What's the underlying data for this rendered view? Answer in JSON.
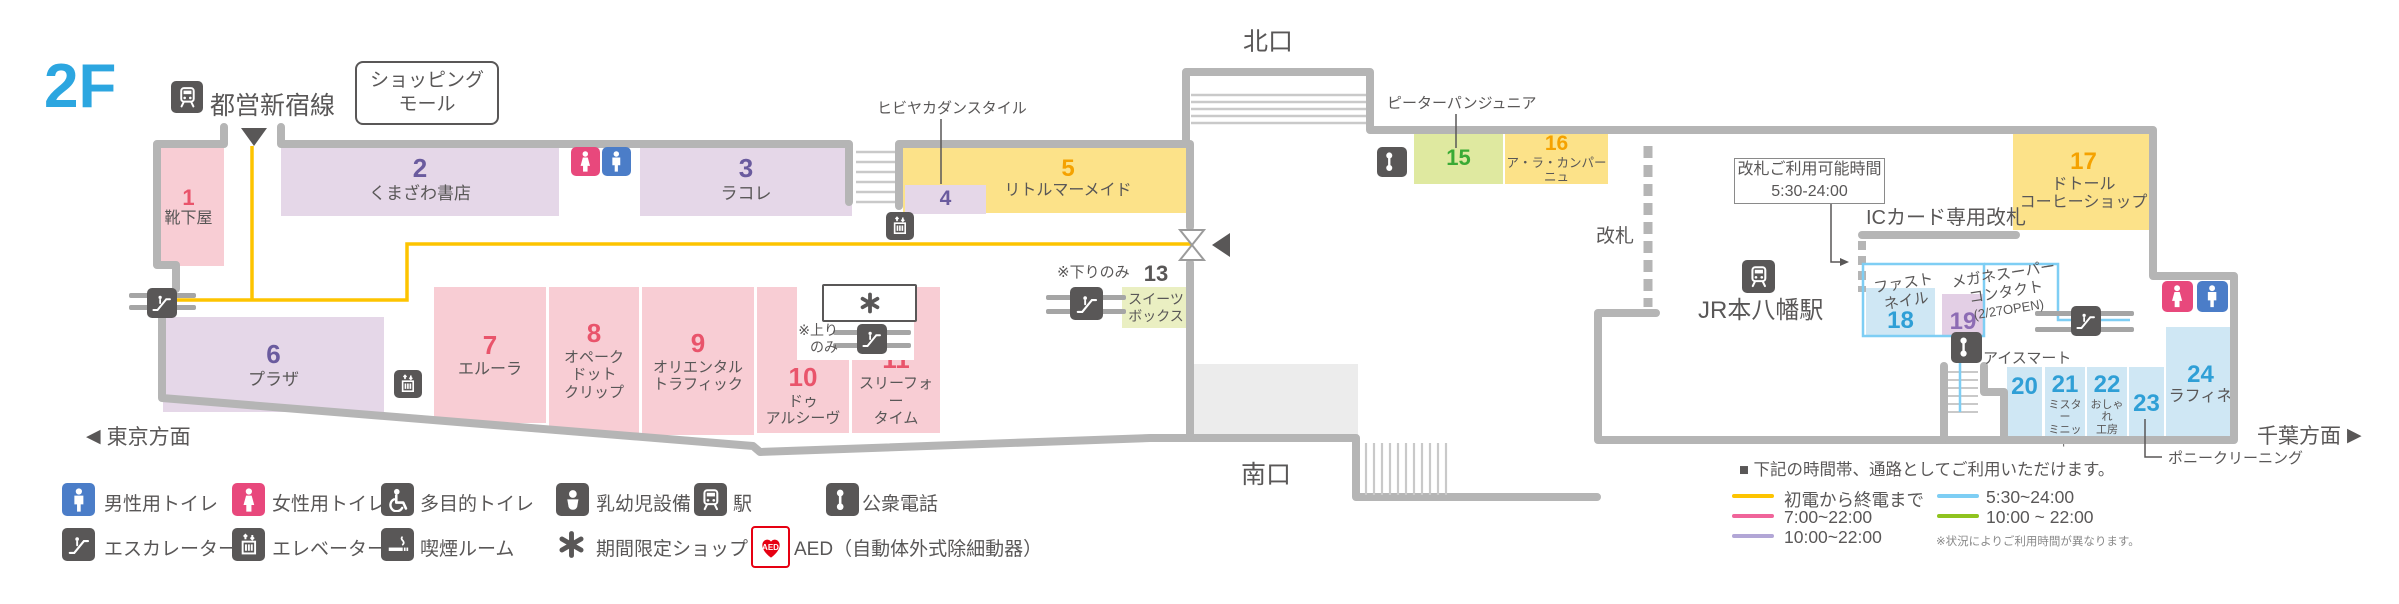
{
  "floor": "2F",
  "toei": {
    "label": "都営新宿線"
  },
  "mall": {
    "line1": "ショッピング",
    "line2": "モール"
  },
  "exits": {
    "north": "北口",
    "south": "南口"
  },
  "directions": {
    "west": "東京方面",
    "east": "千葉方面"
  },
  "station": {
    "jr": "JR本八幡駅",
    "kaisatsu": "改札",
    "ic_gate": "ICカード専用改札",
    "gate_hours_line1": "改札ご利用可能時間",
    "gate_hours_line2": "5:30-24:00"
  },
  "callouts": {
    "hibiya": "ヒビヤカダンスタイル",
    "peter": "ピーターパンジュニア",
    "pony": "ポニークリーニング",
    "ice": "アイスマート",
    "fastnail1": "ファスト",
    "fastnail2": "ネイル",
    "megane1": "メガネスーパー",
    "megane2": "コンタクト",
    "megane3": "(2/27OPEN)",
    "down_only": "※下りのみ",
    "up_only1": "※上り",
    "up_only2": "のみ"
  },
  "shops": {
    "s1": {
      "no": "1",
      "name": "靴下屋"
    },
    "s2": {
      "no": "2",
      "name": "くまざわ書店"
    },
    "s3": {
      "no": "3",
      "name": "ラコレ"
    },
    "s4": {
      "no": "4"
    },
    "s5": {
      "no": "5",
      "name": "リトルマーメイド"
    },
    "s6": {
      "no": "6",
      "name": "プラザ"
    },
    "s7": {
      "no": "7",
      "name": "エルーラ"
    },
    "s8": {
      "no": "8",
      "name1": "オペーク",
      "name2": "ドット",
      "name3": "クリップ"
    },
    "s9": {
      "no": "9",
      "name1": "オリエンタル",
      "name2": "トラフィック"
    },
    "s10": {
      "no": "10",
      "name1": "ドゥ",
      "name2": "アルシーヴ"
    },
    "s11": {
      "no": "11",
      "name1": "スリーフォー",
      "name2": "タイム"
    },
    "s13": {
      "no": "13",
      "name1": "スイーツ",
      "name2": "ボックス"
    },
    "s15": {
      "no": "15"
    },
    "s16": {
      "no": "16",
      "name": "ア・ラ・カンパーニュ"
    },
    "s17": {
      "no": "17",
      "name1": "ドトール",
      "name2": "コーヒーショップ"
    },
    "s18": {
      "no": "18"
    },
    "s19": {
      "no": "19"
    },
    "s20": {
      "no": "20"
    },
    "s21": {
      "no": "21",
      "name1": "ミスター",
      "name2": "ミニット"
    },
    "s22": {
      "no": "22",
      "name1": "おしゃれ",
      "name2": "工房"
    },
    "s23": {
      "no": "23"
    },
    "s24": {
      "no": "24",
      "name": "ラフィネ"
    }
  },
  "legend": {
    "row1": [
      {
        "label": "男性用トイレ"
      },
      {
        "label": "女性用トイレ"
      },
      {
        "label": "多目的トイレ"
      },
      {
        "label": "乳幼児設備"
      },
      {
        "label": "駅"
      },
      {
        "label": "公衆電話"
      }
    ],
    "row2": [
      {
        "label": "エスカレーター"
      },
      {
        "label": "エレベーター"
      },
      {
        "label": "喫煙ルーム"
      },
      {
        "label": "期間限定ショップ"
      },
      {
        "label": "AED（自動体外式除細動器）"
      }
    ],
    "aed_icon_text": "AED"
  },
  "hours": {
    "title": "■ 下記の時間帯、通路としてご利用いただけます。",
    "items": [
      {
        "color": "#fdc400",
        "label": "初電から終電まで"
      },
      {
        "color": "#f0649a",
        "label": "7:00~22:00"
      },
      {
        "color": "#b2a6d6",
        "label": "10:00~22:00"
      },
      {
        "color": "#7ecef4",
        "label": "5:30~24:00"
      },
      {
        "color": "#8fc31f",
        "label": "10:00 ~ 22:00"
      }
    ],
    "note": "※状況によりご利用時間が異なります。"
  },
  "colors": {
    "accent_blue": "#2ca6e0",
    "wall": "#b5b5b5",
    "route_yellow": "#fdc400",
    "route_blue": "#7ecef4",
    "toilet_male": "#4b7dc8",
    "toilet_female": "#e8487c",
    "aed_red": "#e60012"
  }
}
